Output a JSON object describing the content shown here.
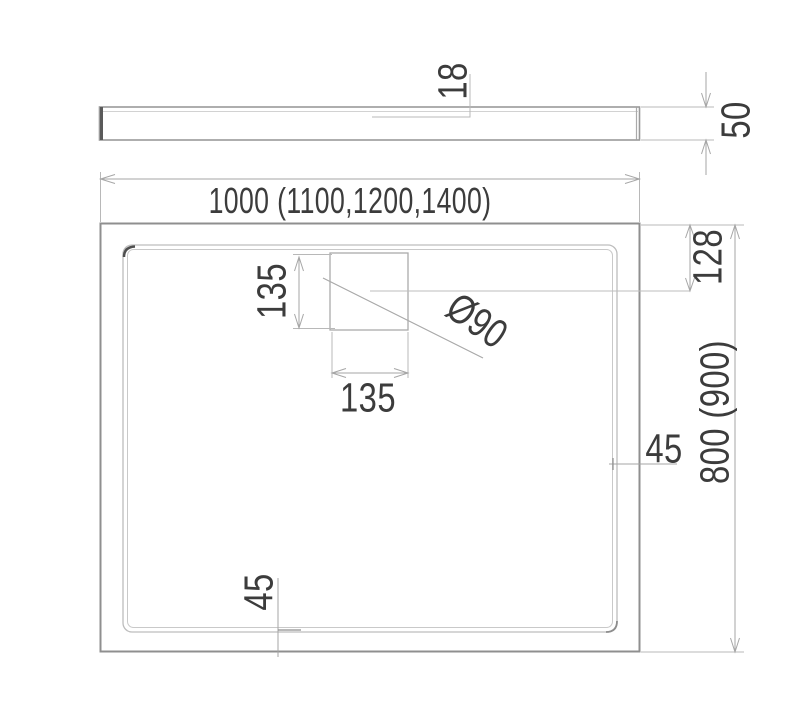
{
  "labels": {
    "profile_thickness": "18",
    "profile_height": "50",
    "tray_width": "1000 (1100,1200,1400)",
    "tray_depth": "800 (900)",
    "drain_offset": "128",
    "drain_box_height": "135",
    "drain_box_width": "135",
    "drain_diameter": "Ø90",
    "rim_gap_right": "45",
    "rim_gap_bottom": "45"
  },
  "colors": {
    "background": "#ffffff",
    "outline": "#8f8f8f",
    "rim_line": "#c0c0c0",
    "dimension_line": "#a6a6a6",
    "text": "#3c3c3c"
  }
}
